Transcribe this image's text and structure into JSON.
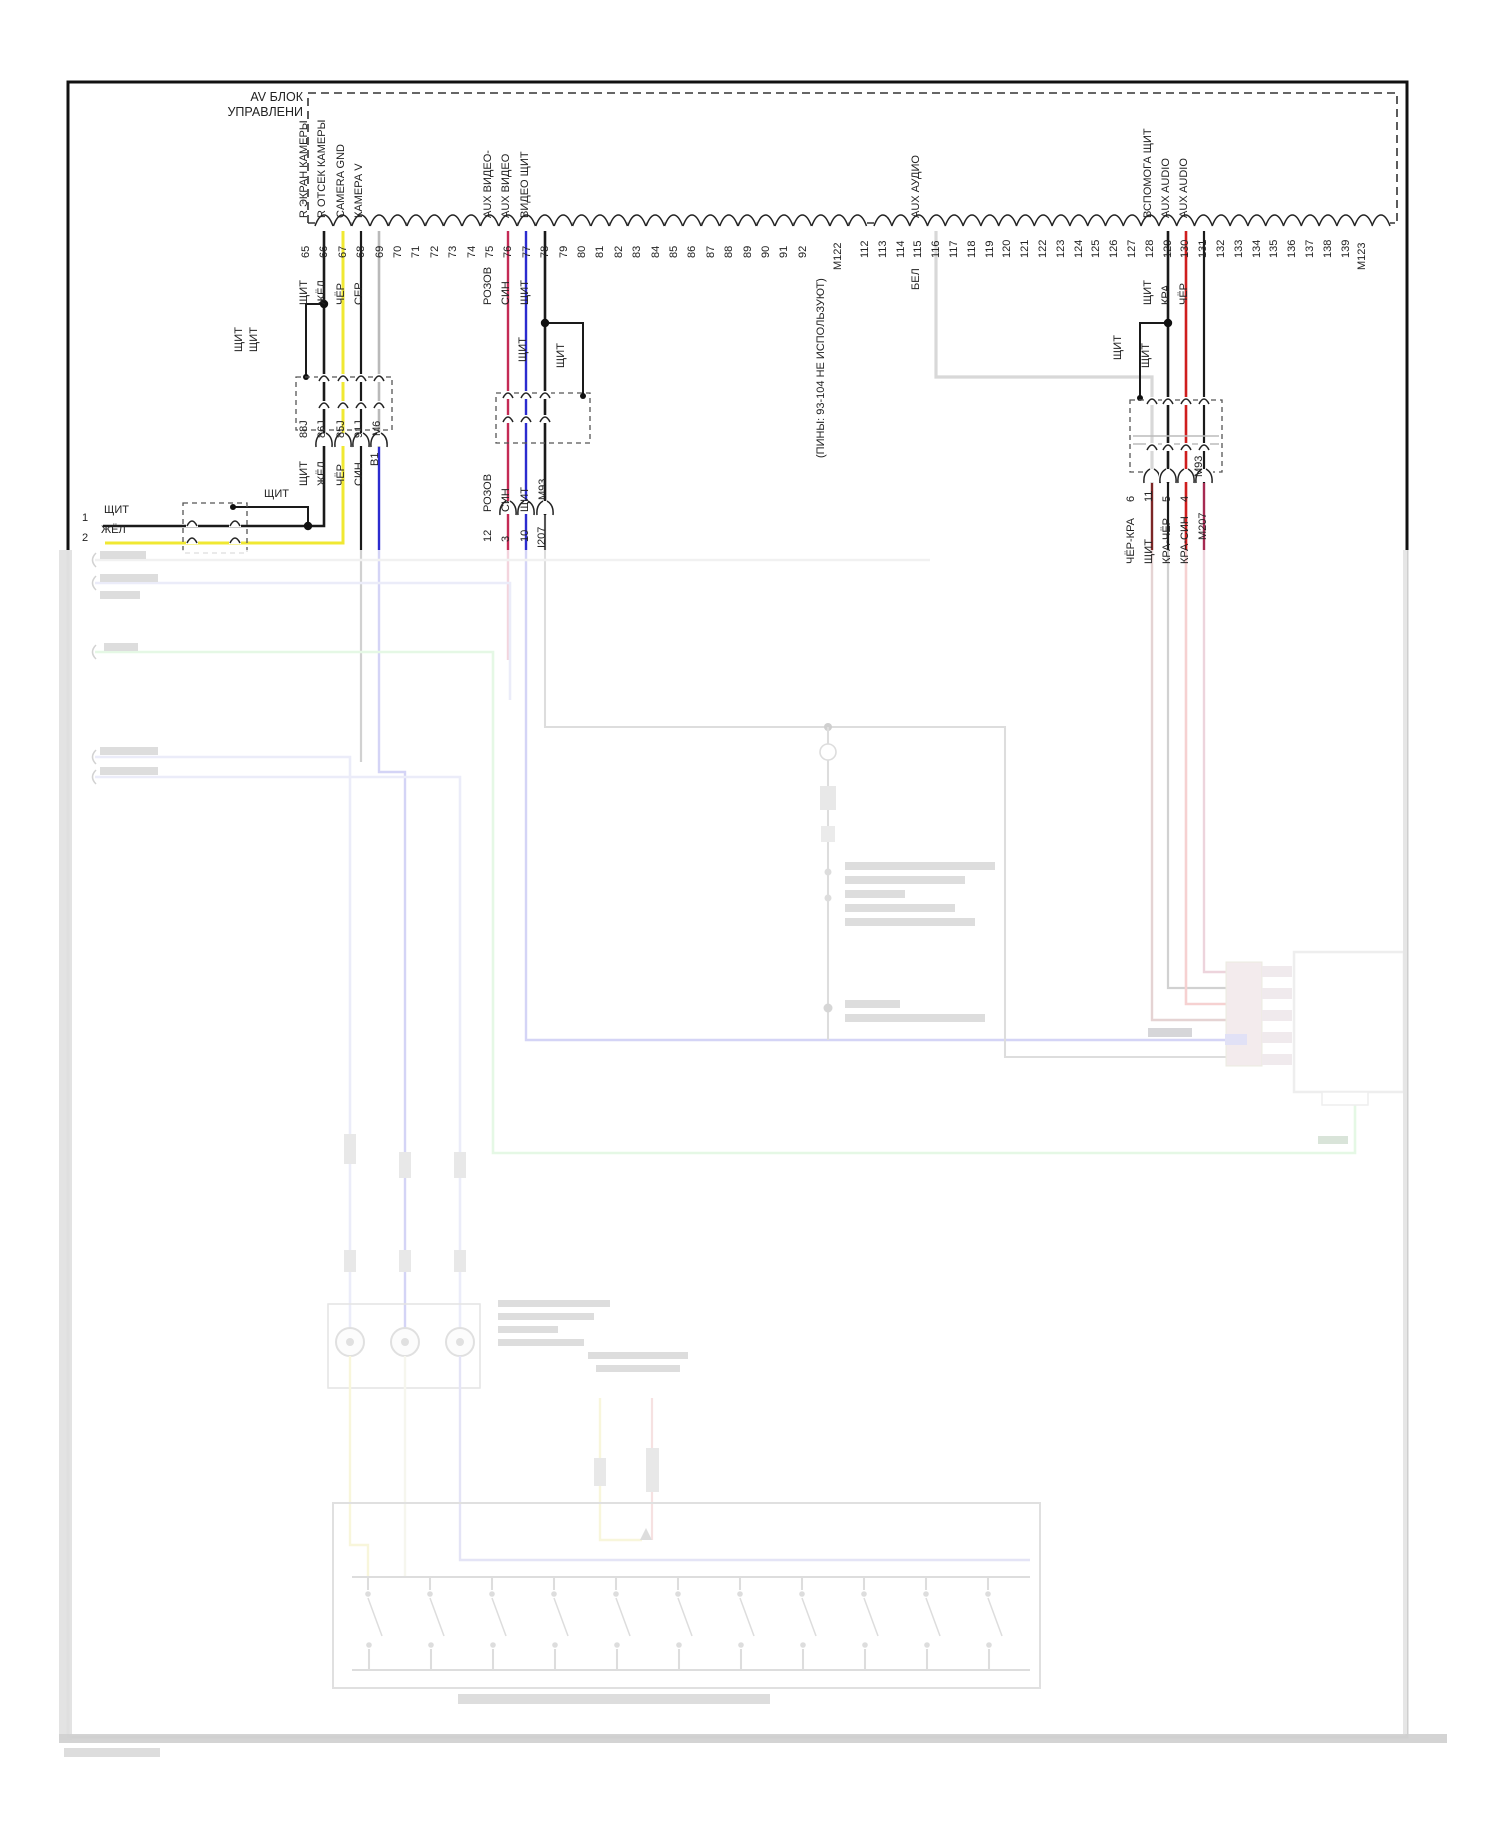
{
  "colors": {
    "black": "#1a1a1a",
    "yellow": "#f0e832",
    "gray": "#b9b9b9",
    "white_wire": "#d8d8d8",
    "blue": "#2b2bcf",
    "pink": "#c42a55",
    "red": "#cf1d1d",
    "dark_red": "#7c2626",
    "crimson": "#a62a52",
    "violet": "#9aa0de",
    "green": "#7ddc7d"
  },
  "title": {
    "line1": "AV БЛОК",
    "line2": "УПРАВЛЕНИ"
  },
  "connector_row": {
    "pins_a": [
      "65",
      "66",
      "67",
      "68",
      "69",
      "70",
      "71",
      "72",
      "73",
      "74",
      "75",
      "76",
      "77",
      "78",
      "79",
      "80",
      "81",
      "82",
      "83",
      "84",
      "85",
      "86",
      "87",
      "88",
      "89",
      "90",
      "91",
      "92"
    ],
    "unused_note": "(ПИНЫ: 93-104 НЕ ИСПОЛЬЗУЮТ)",
    "m122": "М122",
    "pins_b": [
      "112",
      "113",
      "114",
      "115",
      "116",
      "117",
      "118",
      "119",
      "120",
      "121",
      "122",
      "123",
      "124",
      "125",
      "126",
      "127",
      "128",
      "129",
      "130",
      "131",
      "132",
      "133",
      "134",
      "135",
      "136",
      "137",
      "138",
      "139"
    ],
    "m123": "М123"
  },
  "signals": [
    {
      "pin": "65",
      "name": "R ЭКРАН КАМЕРЫ",
      "wire": "ЩИТ"
    },
    {
      "pin": "66",
      "name": "R ОТСЕК КАМЕРЫ",
      "wire": "ЖЁЛ"
    },
    {
      "pin": "67",
      "name": "CAMERA GND",
      "wire": "ЧЁР"
    },
    {
      "pin": "68",
      "name": "КАМЕРА V",
      "wire": "СЕР"
    },
    {
      "pin": "75",
      "name": "AUX ВИДЕО-",
      "wire": "РОЗОВ"
    },
    {
      "pin": "76",
      "name": "AUX ВИДЕО",
      "wire": "СИН"
    },
    {
      "pin": "77",
      "name": "ВИДЕО ЩИТ",
      "wire": "ЩИТ"
    },
    {
      "pin": "115",
      "name": "AUX АУДИО",
      "wire": "БЕЛ"
    },
    {
      "pin": "128",
      "name": "ВСПОМОГА ЩИТ",
      "wire": "ЩИТ"
    },
    {
      "pin": "129",
      "name": "AUX AUDIO",
      "wire": "КРА"
    },
    {
      "pin": "130",
      "name": "AUX AUDIO",
      "wire": "ЧЁР"
    }
  ],
  "left_branch": {
    "bypass_label_1": "ЩИТ",
    "bypass_label_2": "ЩИТ",
    "bypass_label_3": "ЩИТ",
    "j_labels": [
      "88J",
      "86J",
      "85J",
      "91J"
    ],
    "m6": "М6",
    "b1": "B1",
    "wire_labels": [
      "ЩИТ",
      "ЖЁЛ",
      "ЧЁР",
      "СИН"
    ],
    "pin1": "1",
    "pin1_wire": "ЩИТ",
    "pin2": "2",
    "pin2_wire": "ЖЁЛ"
  },
  "middle_branch": {
    "bypass_label_1": "ЩИТ",
    "bypass_label_2": "ЩИТ",
    "wire_labels": [
      "РОЗОВ",
      "СИН",
      "ЩИТ"
    ],
    "m93": "М93",
    "pin_numbers": [
      "12",
      "3",
      "10"
    ],
    "i207": "I207"
  },
  "right_branch": {
    "bypass_label_1": "ЩИТ",
    "bypass_label_2": "ЩИТ",
    "m93": "М93",
    "pin_numbers": [
      "6",
      "11",
      "5",
      "4"
    ],
    "wire_labels": [
      "ЧЁР-КРА",
      "ЩИТ",
      "КРА-ЧЁР",
      "КРА-СИН"
    ],
    "m207": "М207"
  }
}
